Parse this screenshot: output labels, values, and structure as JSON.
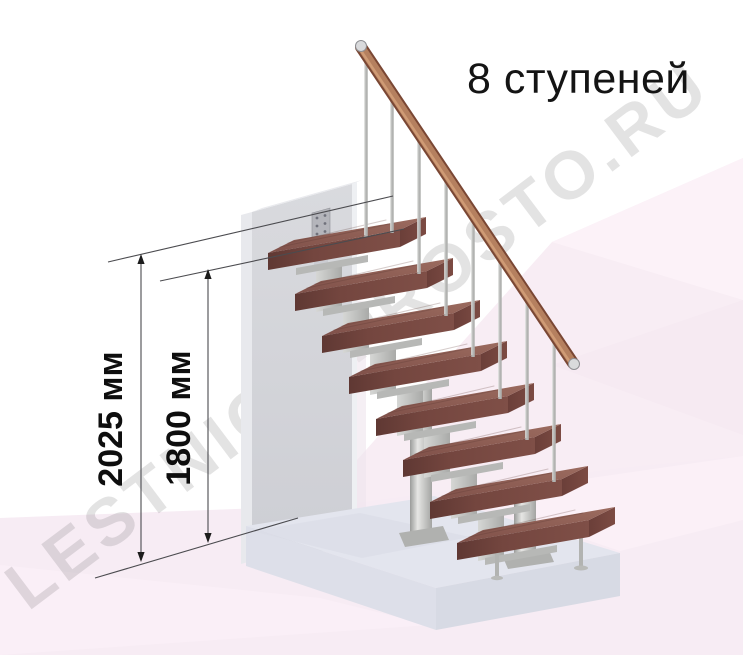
{
  "title": {
    "label": "8 ступеней"
  },
  "dimensions": {
    "total_height": {
      "label": "2025 мм",
      "value": 2025,
      "unit": "мм"
    },
    "rail_height": {
      "label": "1800 мм",
      "value": 1800,
      "unit": "мм"
    }
  },
  "watermark": {
    "text": "LESTNICA-PROSTO.RU"
  },
  "illustration": {
    "steps_count": 8
  },
  "colors": {
    "wood_tread": "#8a5a52",
    "handrail_wood": "#b5805f",
    "metal": "#c9cac8",
    "wall_gray": "#d3d4d9",
    "platform_gray": "#e3e5ee",
    "floor_pink": "#f7ecf4",
    "dimension_line": "#4b4b4f",
    "text": "#141414",
    "watermark_gray": "#e4e4e4"
  }
}
